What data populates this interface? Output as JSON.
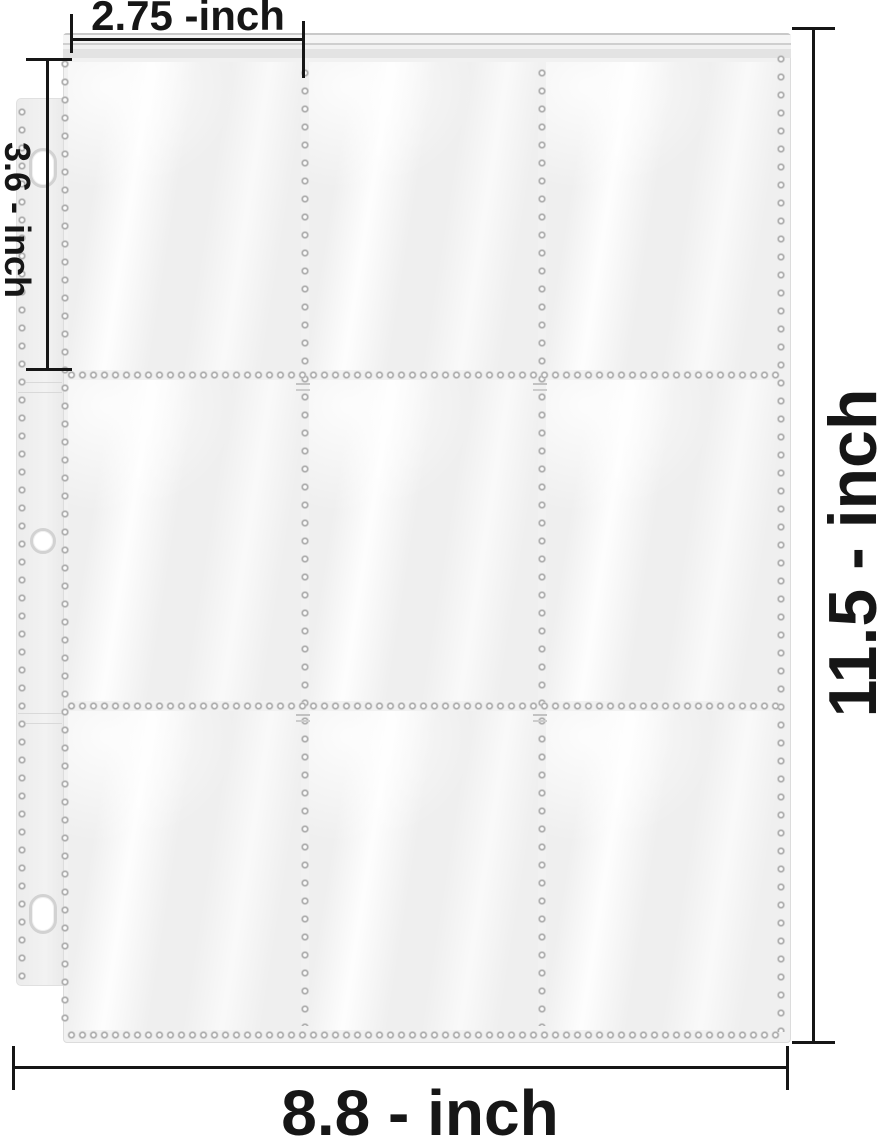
{
  "figure": {
    "title": "9-pocket binder page dimension diagram",
    "description": "Clear 9-pocket trading card page with 3-hole punched binder edge and measurement arrows"
  },
  "dimensions": {
    "pocket_width_label": "2.75 -inch",
    "hole_edge_label": "3.6 - inch",
    "page_height_label": "11.5 - inch",
    "page_width_label": "8.8 - inch"
  },
  "sleeve": {
    "pocket_rows": 3,
    "pocket_cols": 3,
    "binder_holes": 3
  },
  "colors": {
    "background": "#ffffff",
    "sleeve_fill": "#f1f1f1",
    "sleeve_top_seal": "#e3e3e3",
    "perforation_dot": "#9f9f9f",
    "annotation": "#161616"
  }
}
